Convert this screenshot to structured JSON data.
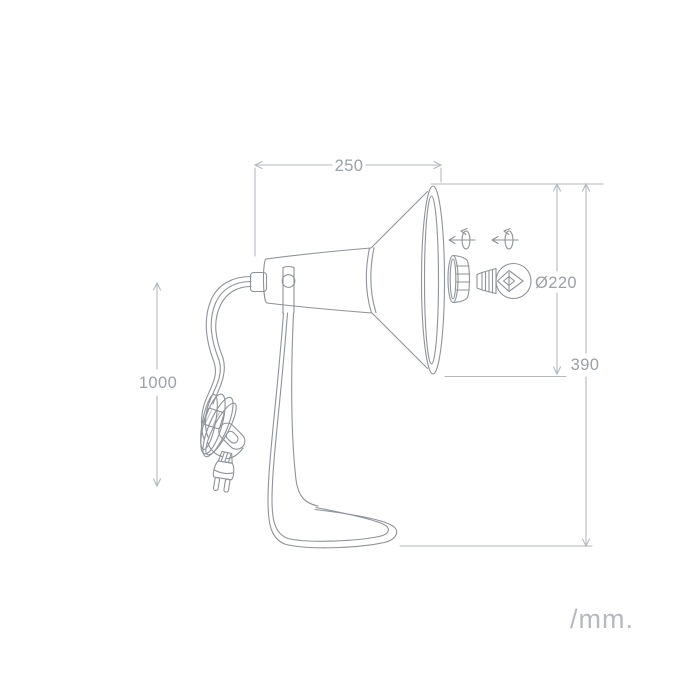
{
  "drawing": {
    "unit_label": "/mm.",
    "dimensions": {
      "shade_length": {
        "value": "250",
        "meaning": "shade length, mm"
      },
      "shade_diameter": {
        "value": "Ø220",
        "meaning": "shade opening diameter, mm"
      },
      "total_height": {
        "value": "390",
        "meaning": "total lamp height, mm"
      },
      "cable_length": {
        "value": "1000",
        "meaning": "power cable length, mm"
      }
    },
    "icons": [
      {
        "name": "rotate-socket-icon",
        "meaning": "socket rotates / slides"
      },
      {
        "name": "rotate-bulb-icon",
        "meaning": "bulb screws in / rotates"
      }
    ],
    "colors": {
      "background": "#ffffff",
      "artwork_line": "#8d939a",
      "dimension_line": "#b3b9bf",
      "dimension_text": "#9aa1a8",
      "unit_text": "#b5bac0",
      "band_fill": "#a9afb5",
      "prong_fill": "#ced3d8"
    }
  }
}
